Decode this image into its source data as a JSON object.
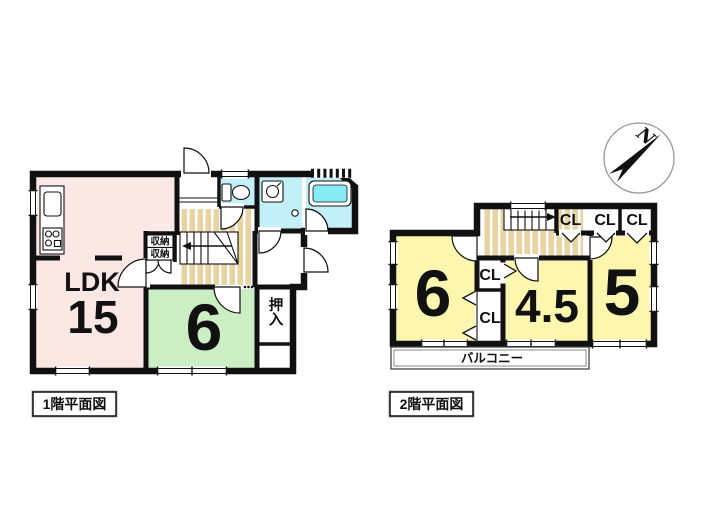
{
  "colors": {
    "wall": "#111111",
    "ldk_pink": "#fbe7e4",
    "room_green": "#cceec4",
    "room_yellow": "#fcf6ae",
    "wet_cyan": "#c3f0f8",
    "bathtub_cyan": "#86ecf5",
    "stair_tan": "#e8d3a2"
  },
  "floor1": {
    "caption": "1階平面図",
    "ldk": {
      "label": "LDK",
      "size": "15"
    },
    "western_room": {
      "size": "6"
    },
    "oshiire": {
      "label": "押入"
    },
    "storage_upper": {
      "label": "収納"
    },
    "storage_lower": {
      "label": "収納"
    }
  },
  "floor2": {
    "caption": "2階平面図",
    "room_west": {
      "size": "6"
    },
    "room_center": {
      "size": "4.5"
    },
    "room_east": {
      "size": "5"
    },
    "closet_top_1": "CL",
    "closet_top_2": "CL",
    "closet_top_3": "CL",
    "closet_mid": "CL",
    "closet_lower": "CL",
    "balcony": "バルコニー"
  },
  "compass": {
    "north": "N"
  }
}
